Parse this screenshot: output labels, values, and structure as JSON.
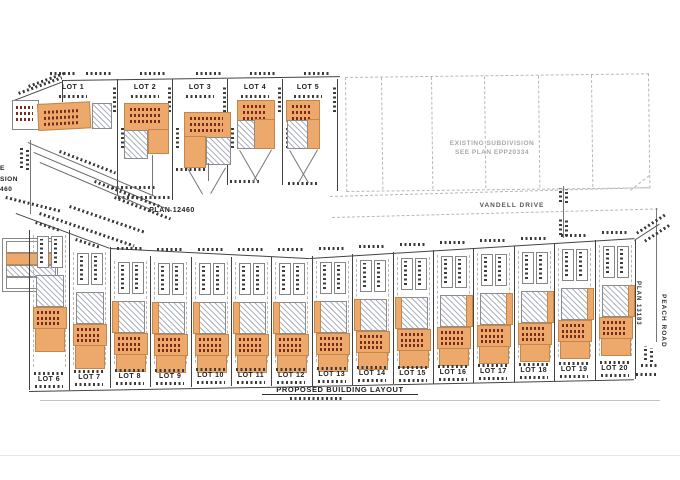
{
  "title": "PROPOSED BUILDING LAYOUT",
  "top_lots": [
    {
      "label": "LOT 1"
    },
    {
      "label": "LOT 2"
    },
    {
      "label": "LOT 3"
    },
    {
      "label": "LOT 4"
    },
    {
      "label": "LOT 5"
    }
  ],
  "bottom_lots": [
    {
      "label": "LOT 6"
    },
    {
      "label": "LOT 7"
    },
    {
      "label": "LOT 8"
    },
    {
      "label": "LOT 9"
    },
    {
      "label": "LOT 10"
    },
    {
      "label": "LOT 11"
    },
    {
      "label": "LOT 12"
    },
    {
      "label": "LOT 13"
    },
    {
      "label": "LOT 14"
    },
    {
      "label": "LOT 15"
    },
    {
      "label": "LOT 16"
    },
    {
      "label": "LOT 17"
    },
    {
      "label": "LOT 18"
    },
    {
      "label": "LOT 19"
    },
    {
      "label": "LOT 20"
    }
  ],
  "labels": {
    "plan_12460": "PLAN 12460",
    "existing_subdivision_line1": "EXISTING SUBDIVISION",
    "existing_subdivision_line2": "SEE PLAN EPP20334",
    "vandell_drive": "VANDELL DRIVE",
    "plan_13183": "PLAN 13183",
    "peach_road": "PEACH ROAD",
    "left_edge_partials": [
      "E",
      "SION",
      "460"
    ]
  },
  "legend": {
    "row_fills": [
      "white",
      "orange",
      "hatch",
      "white"
    ]
  },
  "colors": {
    "building_fill": "#ECA96B",
    "building_border": "#C4874A",
    "annotation_red": "#7A2A1A",
    "line": "#444444",
    "faint_line": "#BBBBBB"
  }
}
